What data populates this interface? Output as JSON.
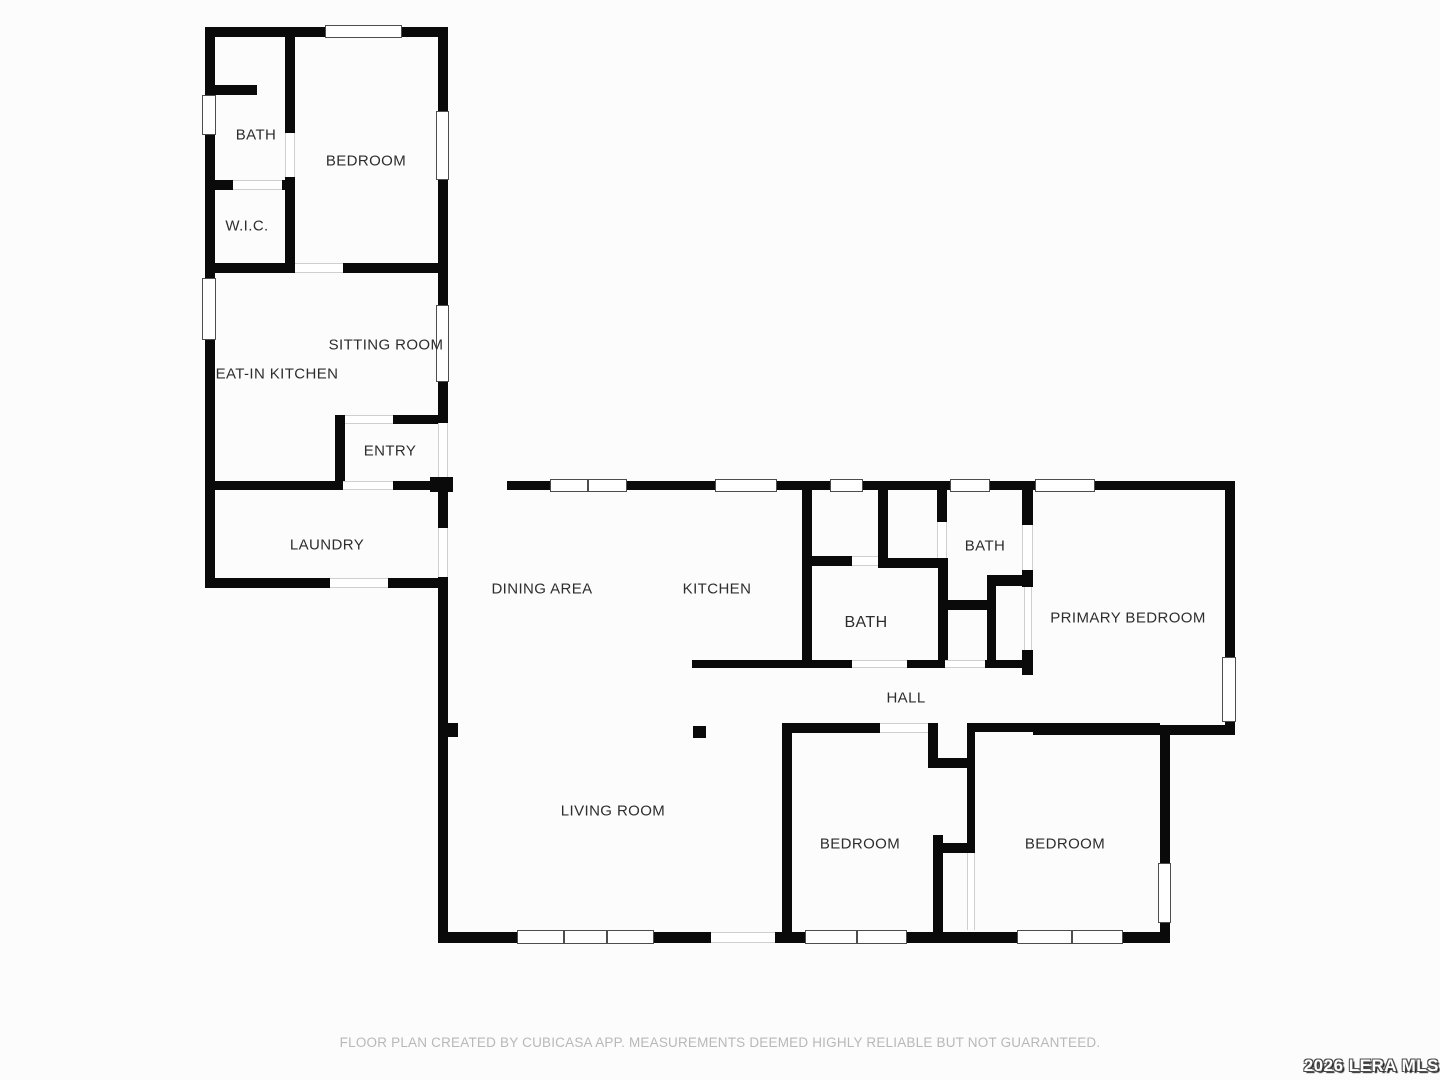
{
  "plan": {
    "rooms": [
      {
        "id": "bath-upper",
        "label": "BATH"
      },
      {
        "id": "bedroom-upper",
        "label": "BEDROOM"
      },
      {
        "id": "wic",
        "label": "W.I.C."
      },
      {
        "id": "sitting-room",
        "label": "SITTING ROOM"
      },
      {
        "id": "eat-in-kitchen",
        "label": "EAT-IN KITCHEN"
      },
      {
        "id": "entry",
        "label": "ENTRY"
      },
      {
        "id": "laundry",
        "label": "LAUNDRY"
      },
      {
        "id": "dining-area",
        "label": "DINING AREA"
      },
      {
        "id": "kitchen",
        "label": "KITCHEN"
      },
      {
        "id": "bath-hall",
        "label": "BATH"
      },
      {
        "id": "bath-primary",
        "label": "BATH"
      },
      {
        "id": "primary-bedroom",
        "label": "PRIMARY BEDROOM"
      },
      {
        "id": "hall",
        "label": "HALL"
      },
      {
        "id": "living-room",
        "label": "LIVING ROOM"
      },
      {
        "id": "bedroom-mid",
        "label": "BEDROOM"
      },
      {
        "id": "bedroom-right",
        "label": "BEDROOM"
      }
    ]
  },
  "footer": {
    "disclaimer": "FLOOR PLAN CREATED BY CUBICASA APP. MEASUREMENTS DEEMED HIGHLY RELIABLE BUT NOT GUARANTEED."
  },
  "watermark": {
    "text": "2026 LERA MLS"
  },
  "colors": {
    "wall": "#0a0a0a",
    "background": "#fcfcfc",
    "room_label": "#2d2d2d",
    "disclaimer_text": "#b8b8b8",
    "window_border": "#4d4d4d",
    "door_jamb_line": "#cfcfcf",
    "watermark_text": "#ffffff",
    "watermark_outline": "#4a4a4a"
  }
}
